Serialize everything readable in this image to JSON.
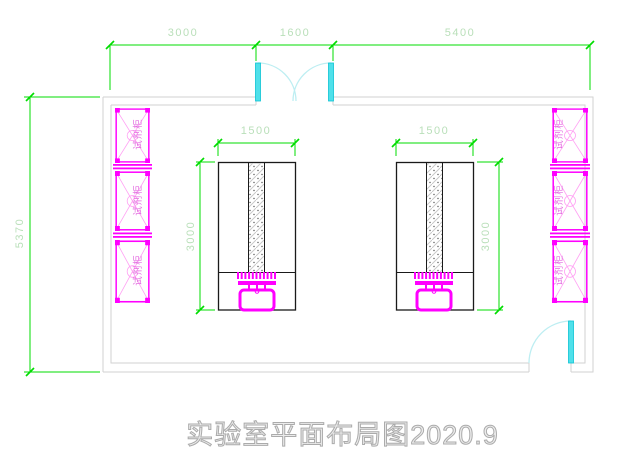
{
  "title": "实验室平面布局图2020.9",
  "dimensions": {
    "top_widths": [
      "3000",
      "1600",
      "5400"
    ],
    "room_height": "5370",
    "bench_left": {
      "width": "1500",
      "length": "3000"
    },
    "bench_right": {
      "width": "1500",
      "length": "3000"
    }
  },
  "cabinets": {
    "label": "试剂柜",
    "left_count": 3,
    "right_count": 3
  },
  "colors": {
    "dimension_line": "#00dd00",
    "dimension_text": "#b9dfb9",
    "cabinet": "#ff00ff",
    "cabinet_accent": "#ff9ff3",
    "cabinet_text": "#e36de0",
    "door": "#4fe0ea",
    "door_arc": "#bdeef2",
    "wall": "#d2d2d2",
    "bench_outline": "#1a1a1a",
    "sink": "#ff00ff",
    "title_text": "#ababab"
  }
}
